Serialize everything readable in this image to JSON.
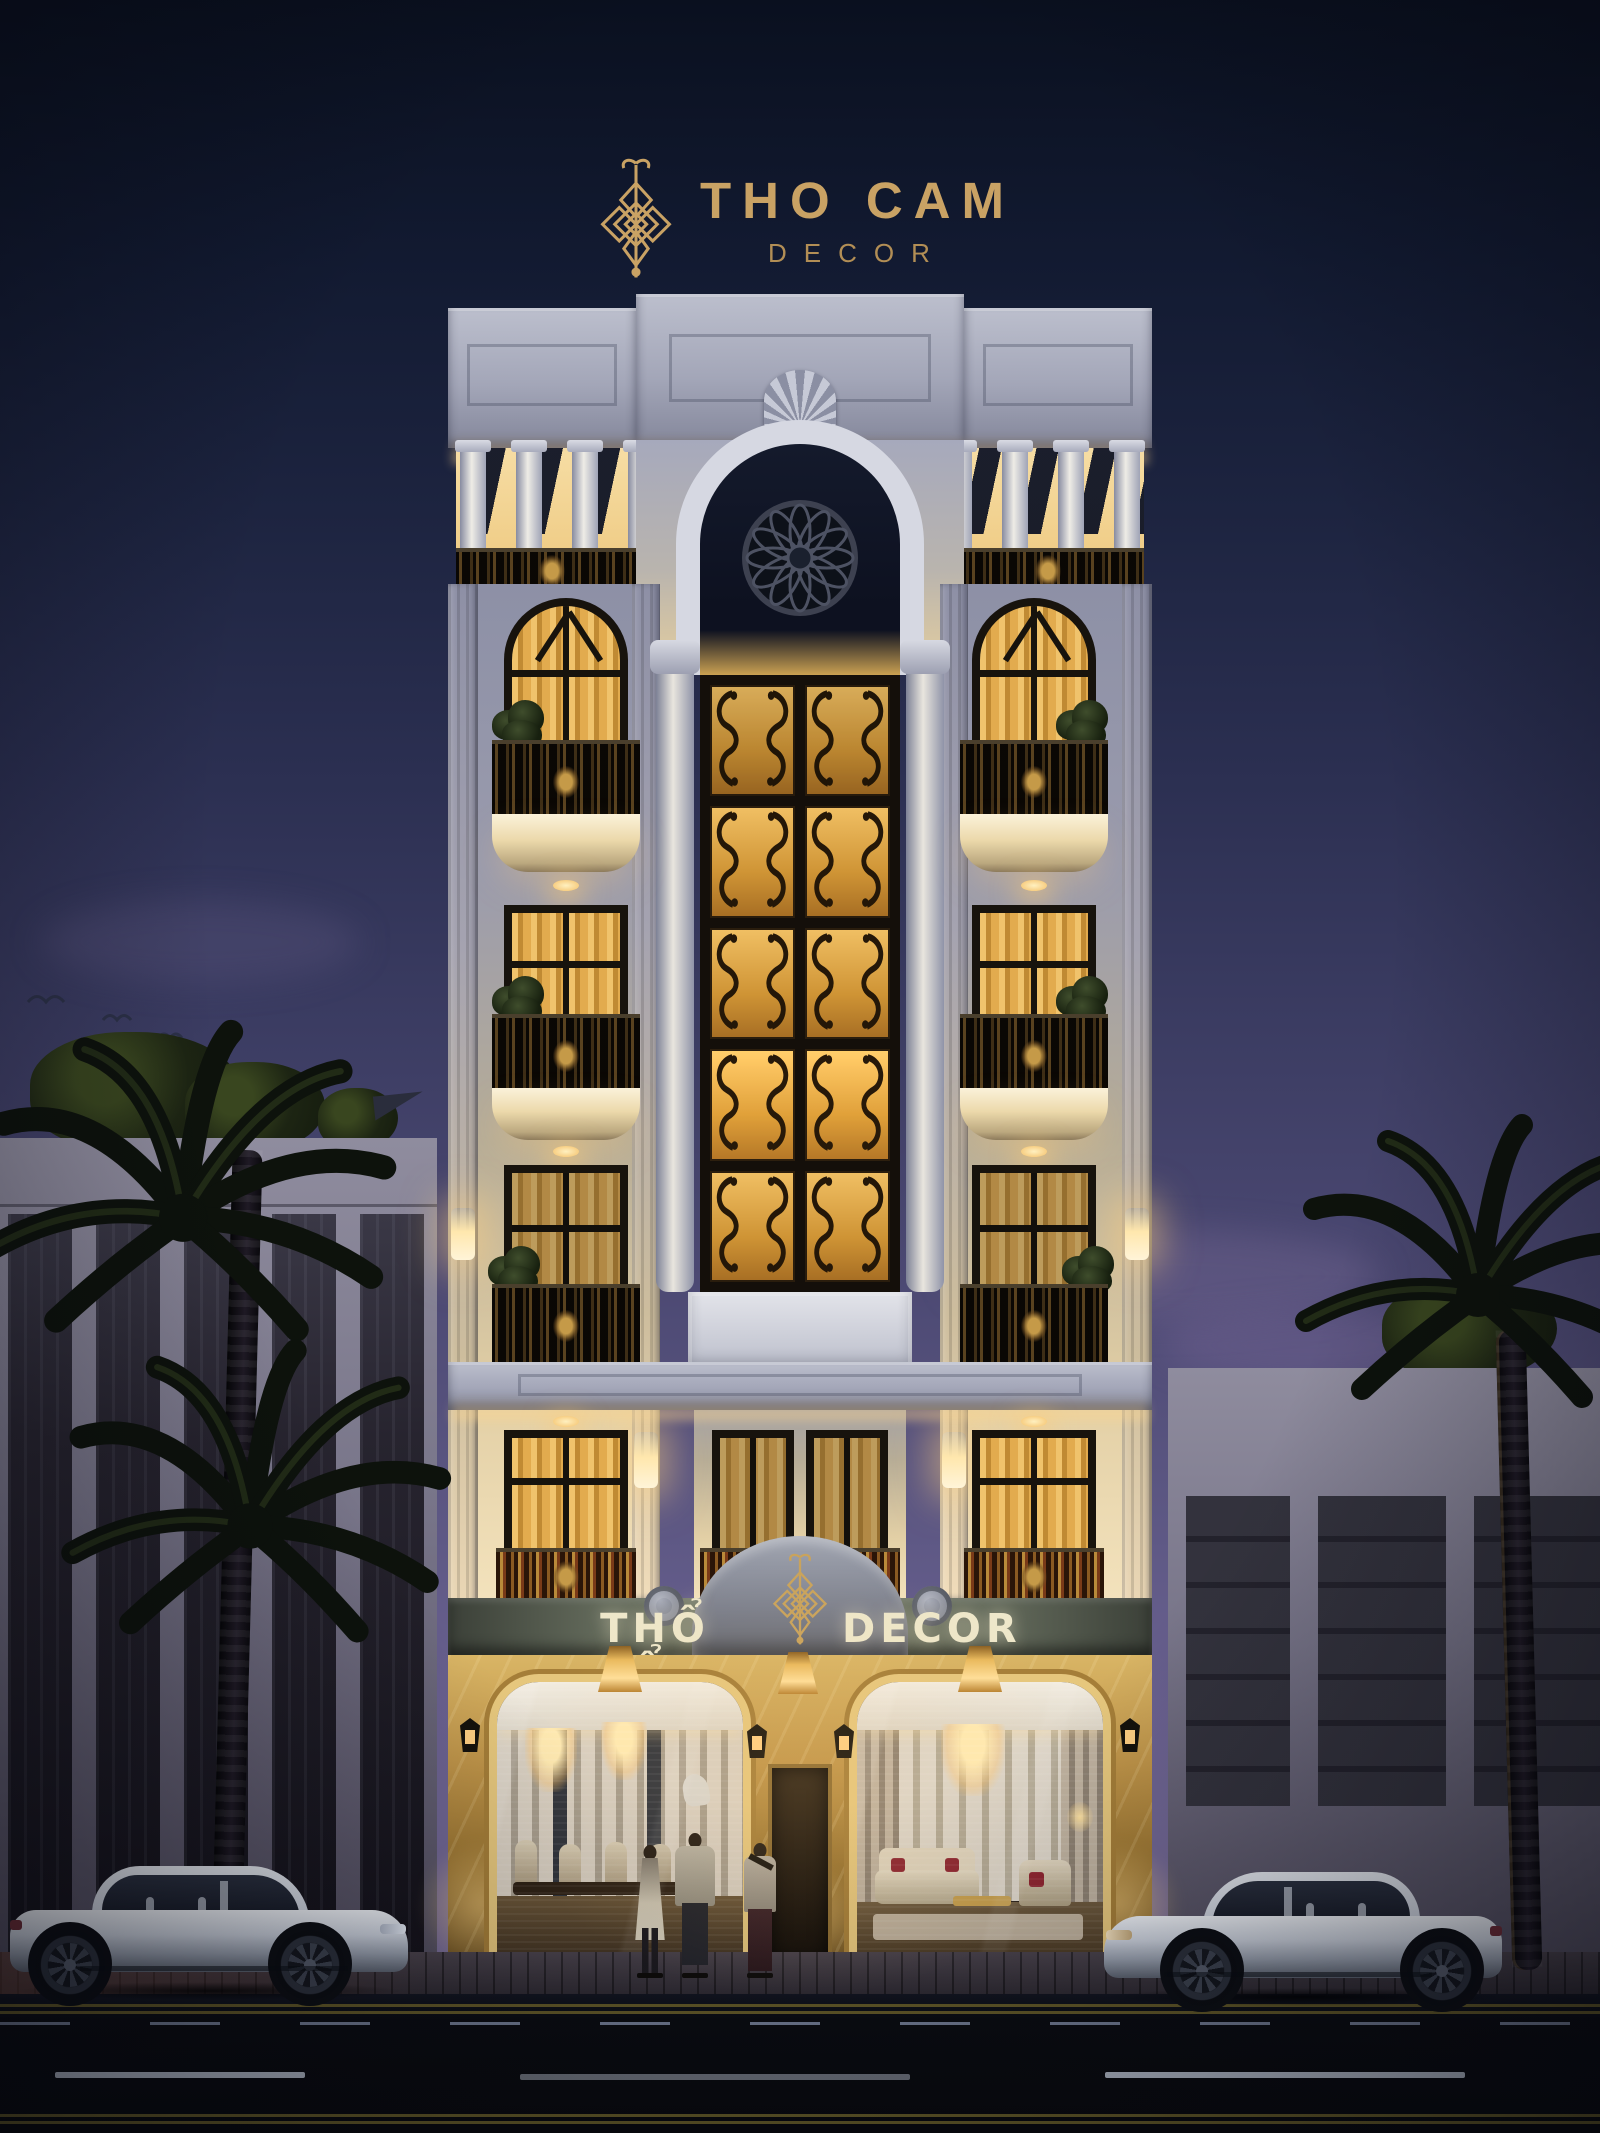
{
  "meta": {
    "scene_type": "night-time 3D exterior render of a neoclassical decor shophouse"
  },
  "rooftop_logo": {
    "icon": "endless-knot-icon",
    "title": "THO CAM",
    "subtitle": "DECOR",
    "gold": "#c9a264"
  },
  "facade_sign": {
    "left": "THỔ CẨM",
    "right": "DECOR",
    "emblem": "endless-knot-icon",
    "text_color": "#eee7ca",
    "band_color": "#747b6a"
  },
  "building": {
    "style": "neoclassical facade, warm uplighting",
    "facade_shadow_color": "#9a9bad",
    "facade_warm_color": "#f3e2bc",
    "accent_gold": "#caa35c",
    "rooftop_colonnade_columns": 8,
    "rose_window": true,
    "central_iron_panels": 10,
    "window_rows_per_side": 4,
    "balconies_per_side": 3,
    "storefronts": 2,
    "pendant_lamps": 3,
    "wall_lanterns": 4
  },
  "storefront_left_scene": "dining showroom with chandeliers, table and cream chairs",
  "storefront_right_scene": "living room showroom with chandelier, cream sofas and red pillows",
  "surroundings": {
    "left_building": {
      "color": "#8f8c9e",
      "dark_window_strips": 5
    },
    "right_building": {
      "color": "#8f8c9e",
      "dark_windows": 3
    },
    "palm_trees": 3,
    "street_trees": 4,
    "birds": 4
  },
  "street": {
    "cars": [
      {
        "type": "white coupe",
        "facing": "right",
        "side": "left"
      },
      {
        "type": "white coupe",
        "facing": "left",
        "side": "right"
      }
    ],
    "pedestrians": 3,
    "road_markings": {
      "double_yellow_lines": 2,
      "dashed_white_lines": true
    },
    "sidewalk": "dark cobblestone"
  },
  "lighting": {
    "sky_top": "#0a101f",
    "sky_horizon": "#7d719b",
    "window_glow": "#e2ab4e",
    "lamp_glow": "#ffd98f"
  }
}
